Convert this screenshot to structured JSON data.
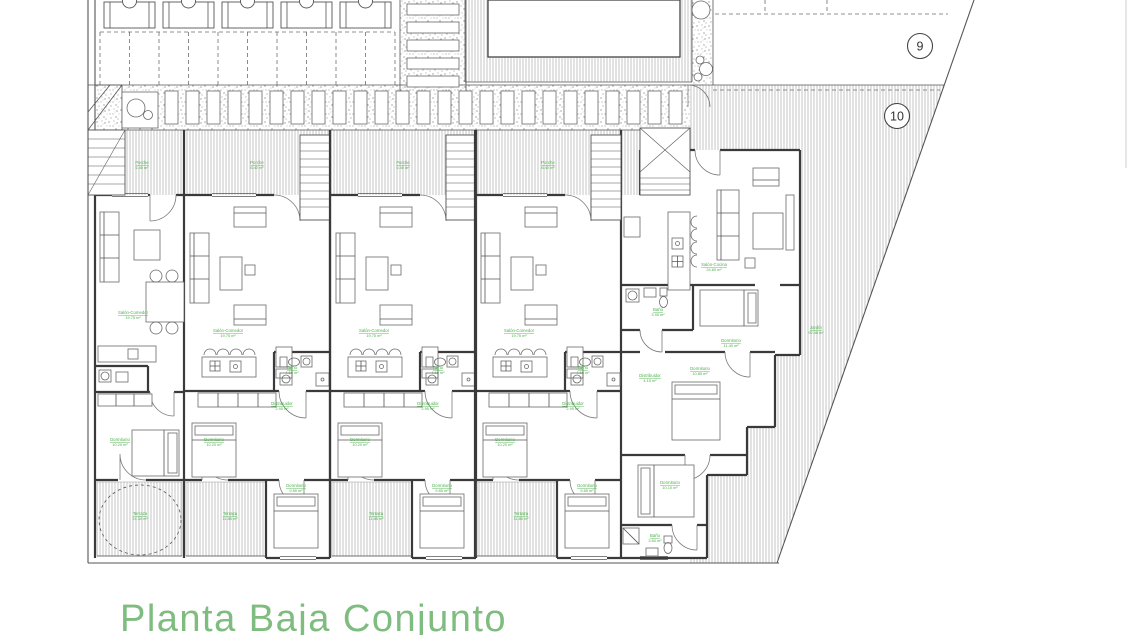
{
  "title": {
    "text": "Planta Baja Conjunto",
    "color": "#7fbc7f"
  },
  "label_color": "#4db04d",
  "markers": [
    {
      "label": "9"
    },
    {
      "label": "10"
    }
  ],
  "rooms": [
    {
      "x": 142,
      "y": 164,
      "name": "Porche",
      "area": "6.40 m²"
    },
    {
      "x": 133,
      "y": 314,
      "name": "Salón-Comedor",
      "area": "19.75 m²"
    },
    {
      "x": 120,
      "y": 441,
      "name": "Dormitorio",
      "area": "10.20 m²"
    },
    {
      "x": 140,
      "y": 515,
      "name": "Terraza",
      "area": "24.30 m²"
    },
    {
      "x": 257,
      "y": 164,
      "name": "Porche",
      "area": "6.40 m²"
    },
    {
      "x": 228,
      "y": 332,
      "name": "Salón-Comedor",
      "area": "19.75 m²"
    },
    {
      "x": 292,
      "y": 369,
      "name": "Baño",
      "area": "4.10 m²"
    },
    {
      "x": 282,
      "y": 405,
      "name": "Distribuidor",
      "area": "2.95 m²"
    },
    {
      "x": 214,
      "y": 441,
      "name": "Dormitorio",
      "area": "10.20 m²"
    },
    {
      "x": 296,
      "y": 487,
      "name": "Dormitorio",
      "area": "9.85 m²"
    },
    {
      "x": 230,
      "y": 515,
      "name": "Terraza",
      "area": "11.85 m²"
    },
    {
      "x": 403,
      "y": 164,
      "name": "Porche",
      "area": "6.40 m²"
    },
    {
      "x": 374,
      "y": 332,
      "name": "Salón-Comedor",
      "area": "19.75 m²"
    },
    {
      "x": 438,
      "y": 369,
      "name": "Baño",
      "area": "4.10 m²"
    },
    {
      "x": 428,
      "y": 405,
      "name": "Distribuidor",
      "area": "2.95 m²"
    },
    {
      "x": 360,
      "y": 441,
      "name": "Dormitorio",
      "area": "10.20 m²"
    },
    {
      "x": 442,
      "y": 487,
      "name": "Dormitorio",
      "area": "9.85 m²"
    },
    {
      "x": 376,
      "y": 515,
      "name": "Terraza",
      "area": "11.85 m²"
    },
    {
      "x": 548,
      "y": 164,
      "name": "Porche",
      "area": "6.40 m²"
    },
    {
      "x": 519,
      "y": 332,
      "name": "Salón-Comedor",
      "area": "19.75 m²"
    },
    {
      "x": 583,
      "y": 369,
      "name": "Baño",
      "area": "4.10 m²"
    },
    {
      "x": 573,
      "y": 405,
      "name": "Distribuidor",
      "area": "2.95 m²"
    },
    {
      "x": 505,
      "y": 441,
      "name": "Dormitorio",
      "area": "10.20 m²"
    },
    {
      "x": 587,
      "y": 487,
      "name": "Dormitorio",
      "area": "9.85 m²"
    },
    {
      "x": 521,
      "y": 515,
      "name": "Terraza",
      "area": "11.85 m²"
    },
    {
      "x": 714,
      "y": 266,
      "name": "Salón-Cocina",
      "area": "24.60 m²"
    },
    {
      "x": 658,
      "y": 311,
      "name": "Baño",
      "area": "3.95 m²"
    },
    {
      "x": 731,
      "y": 342,
      "name": "Dormitorio",
      "area": "11.40 m²"
    },
    {
      "x": 650,
      "y": 377,
      "name": "Distribuidor",
      "area": "4.15 m²"
    },
    {
      "x": 700,
      "y": 370,
      "name": "Dormitorio",
      "area": "10.85 m²"
    },
    {
      "x": 670,
      "y": 484,
      "name": "Dormitorio",
      "area": "10.10 m²"
    },
    {
      "x": 655,
      "y": 537,
      "name": "Baño",
      "area": "3.60 m²"
    },
    {
      "x": 816,
      "y": 329,
      "name": "Jardín",
      "area": "92.40 m²"
    }
  ]
}
